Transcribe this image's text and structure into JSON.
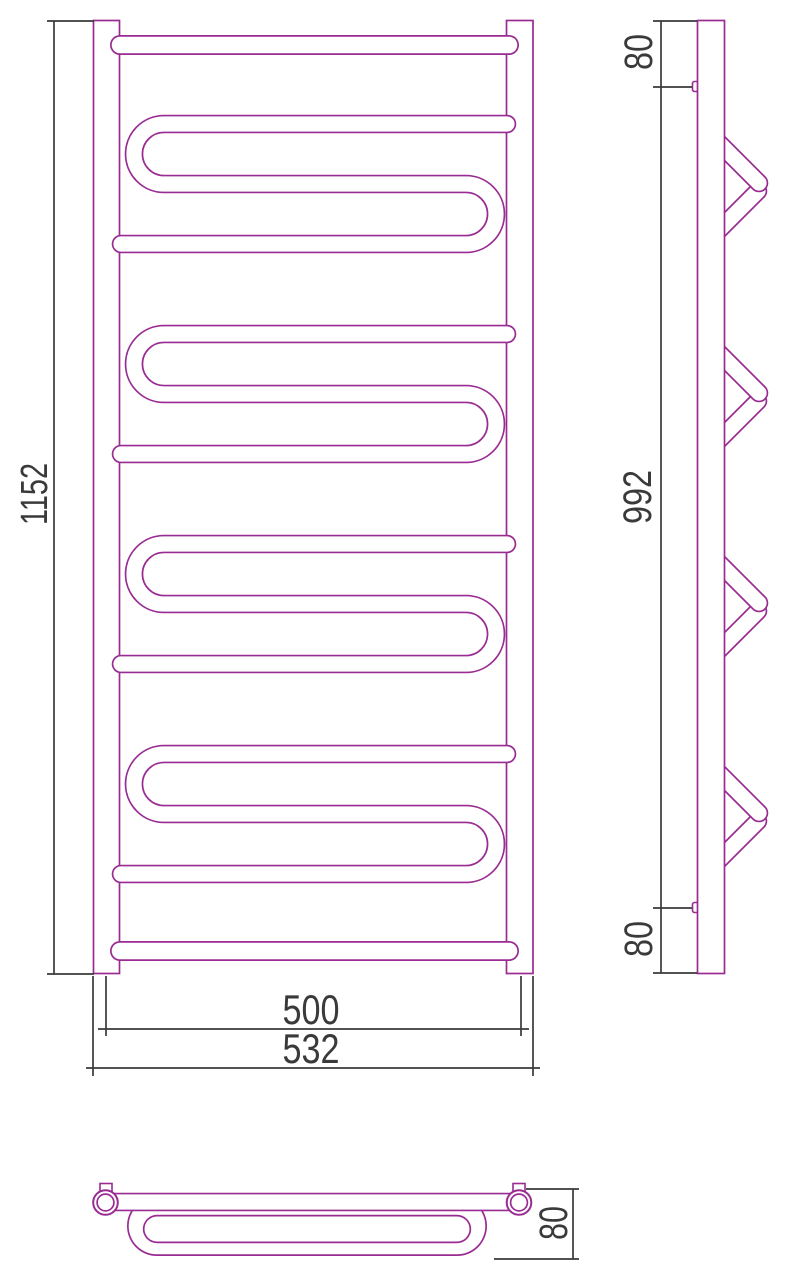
{
  "front_view": {
    "height": "1152",
    "mount_width": "500",
    "overall_width": "532"
  },
  "side_view": {
    "top_offset": "80",
    "mount_span": "992",
    "bottom_offset": "80"
  },
  "top_view": {
    "depth": "80"
  },
  "colors": {
    "pipe": "#992b92",
    "dim": "#3a3a3a",
    "bg": "#ffffff"
  }
}
